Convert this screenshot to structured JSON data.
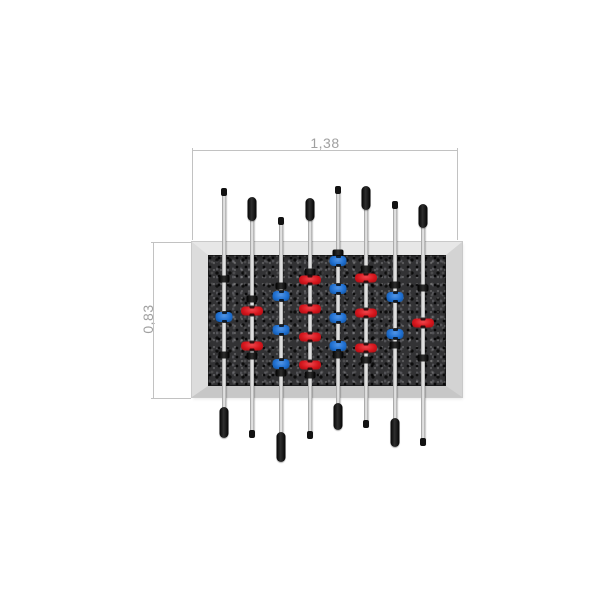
{
  "drawing": {
    "type": "foosball-table-top-view-dimension-drawing",
    "dimensions": {
      "width_label": "1,38",
      "height_label": "0,83"
    }
  },
  "colors": {
    "dim_line": "#c2c2c2",
    "dim_text": "#a0a0a0",
    "field": "#323234",
    "handle": "#2e2e2e",
    "team_red": "#d5161d",
    "team_blue": "#1f6fd0"
  },
  "rods": [
    {
      "index": 1,
      "team": "blue",
      "x": 224,
      "line": [
        192,
        410
      ],
      "top_end": {
        "type": "cap",
        "y": 188,
        "h": 8
      },
      "bottom_end": {
        "type": "handle",
        "y": 407,
        "h": 31
      },
      "bumpers": [
        279,
        355
      ],
      "players": [
        317
      ]
    },
    {
      "index": 2,
      "team": "red",
      "x": 252,
      "line": [
        218,
        436
      ],
      "top_end": {
        "type": "handle",
        "y": 197,
        "h": 24
      },
      "bottom_end": {
        "type": "cap",
        "y": 430,
        "h": 8
      },
      "bumpers": [
        299,
        356
      ],
      "players": [
        311,
        346
      ]
    },
    {
      "index": 3,
      "team": "blue",
      "x": 281,
      "line": [
        220,
        434
      ],
      "top_end": {
        "type": "cap",
        "y": 217,
        "h": 8
      },
      "bottom_end": {
        "type": "handle",
        "y": 432,
        "h": 30
      },
      "bumpers": [
        286,
        373
      ],
      "players": [
        296,
        330,
        364
      ]
    },
    {
      "index": 4,
      "team": "red",
      "x": 310,
      "line": [
        219,
        436
      ],
      "top_end": {
        "type": "handle",
        "y": 198,
        "h": 23
      },
      "bottom_end": {
        "type": "cap",
        "y": 431,
        "h": 8
      },
      "bumpers": [
        272,
        375
      ],
      "players": [
        280,
        309,
        337,
        365
      ]
    },
    {
      "index": 5,
      "team": "blue",
      "x": 338,
      "line": [
        190,
        406
      ],
      "top_end": {
        "type": "cap",
        "y": 186,
        "h": 8
      },
      "bottom_end": {
        "type": "handle",
        "y": 403,
        "h": 27
      },
      "bumpers": [
        253,
        355
      ],
      "players": [
        261,
        289,
        318,
        346
      ]
    },
    {
      "index": 6,
      "team": "red",
      "x": 366,
      "line": [
        208,
        426
      ],
      "top_end": {
        "type": "handle",
        "y": 186,
        "h": 24
      },
      "bottom_end": {
        "type": "cap",
        "y": 420,
        "h": 8
      },
      "bumpers": [
        269,
        360
      ],
      "players": [
        278,
        313,
        348
      ]
    },
    {
      "index": 7,
      "team": "blue",
      "x": 395,
      "line": [
        205,
        421
      ],
      "top_end": {
        "type": "cap",
        "y": 201,
        "h": 8
      },
      "bottom_end": {
        "type": "handle",
        "y": 418,
        "h": 29
      },
      "bumpers": [
        285,
        345
      ],
      "players": [
        297,
        334
      ]
    },
    {
      "index": 8,
      "team": "red",
      "x": 423,
      "line": [
        226,
        444
      ],
      "top_end": {
        "type": "handle",
        "y": 204,
        "h": 24
      },
      "bottom_end": {
        "type": "cap",
        "y": 438,
        "h": 8
      },
      "bumpers": [
        288,
        358
      ],
      "players": [
        323
      ]
    }
  ]
}
